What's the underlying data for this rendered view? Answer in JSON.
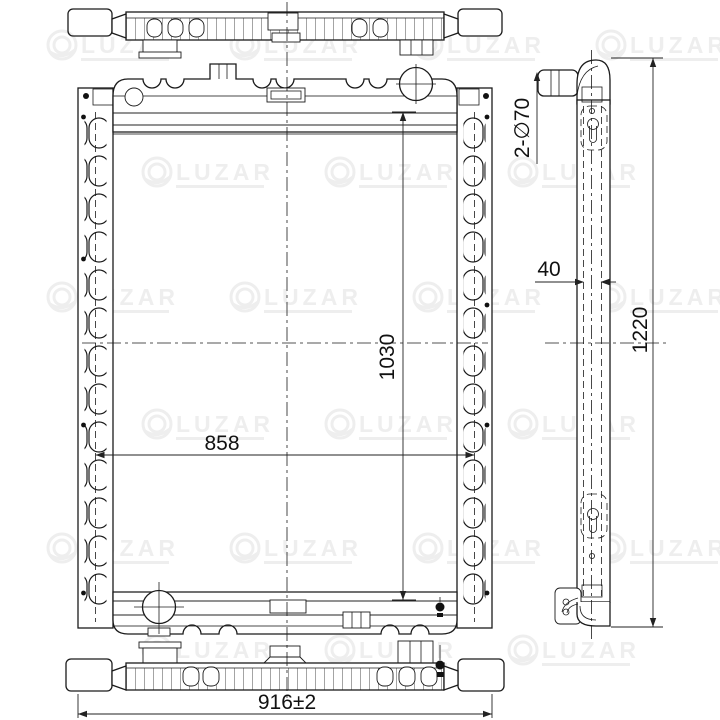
{
  "drawing": {
    "subject": "radiator-technical-drawing",
    "views": {
      "top": "top view",
      "front": "front view",
      "side": "side view",
      "bottom": "bottom view"
    },
    "dimensions": {
      "core_width_mm": "858",
      "core_height_mm": "1030",
      "overall_width_mm": "916±2",
      "overall_height_mm": "1220",
      "core_depth_mm": "40",
      "inlet_outlet_pipes": "2-∅70"
    },
    "colors": {
      "line": "#1b1b1b",
      "background": "#ffffff",
      "dimension_text": "#111111",
      "watermark": "#4a4a4a"
    }
  },
  "watermark": {
    "brand": "LUZAR",
    "positions": [
      [
        100,
        45
      ],
      [
        283,
        45
      ],
      [
        466,
        45
      ],
      [
        649,
        45
      ],
      [
        195,
        172
      ],
      [
        378,
        172
      ],
      [
        561,
        172
      ],
      [
        100,
        297
      ],
      [
        283,
        297
      ],
      [
        466,
        297
      ],
      [
        649,
        297
      ],
      [
        195,
        424
      ],
      [
        378,
        424
      ],
      [
        561,
        424
      ],
      [
        100,
        548
      ],
      [
        283,
        548
      ],
      [
        466,
        548
      ],
      [
        649,
        548
      ],
      [
        195,
        650
      ],
      [
        378,
        650
      ],
      [
        561,
        650
      ]
    ]
  }
}
